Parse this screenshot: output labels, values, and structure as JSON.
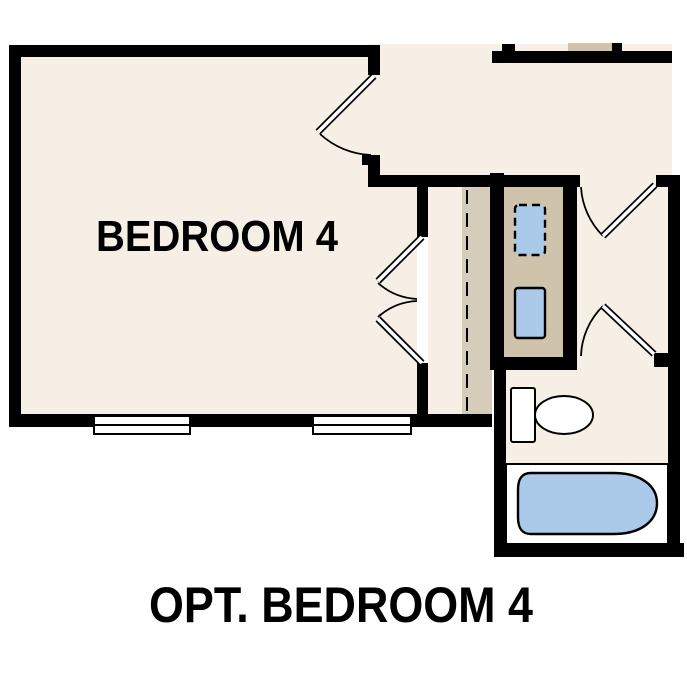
{
  "labels": {
    "room": "BEDROOM 4",
    "caption": "OPT. BEDROOM 4"
  },
  "colors": {
    "background": "#ffffff",
    "floor_cream": "#f6efe5",
    "cabinet_tan": "#cfc3ab",
    "stairs_tan": "#d5ccb9",
    "fixture_blue": "#abc9e9",
    "wall_black": "#000000",
    "window_white": "#ffffff"
  },
  "fixtures": [
    "toilet",
    "bathtub",
    "washer-dryer",
    "window",
    "door-swing",
    "stairs-dashed-line"
  ]
}
